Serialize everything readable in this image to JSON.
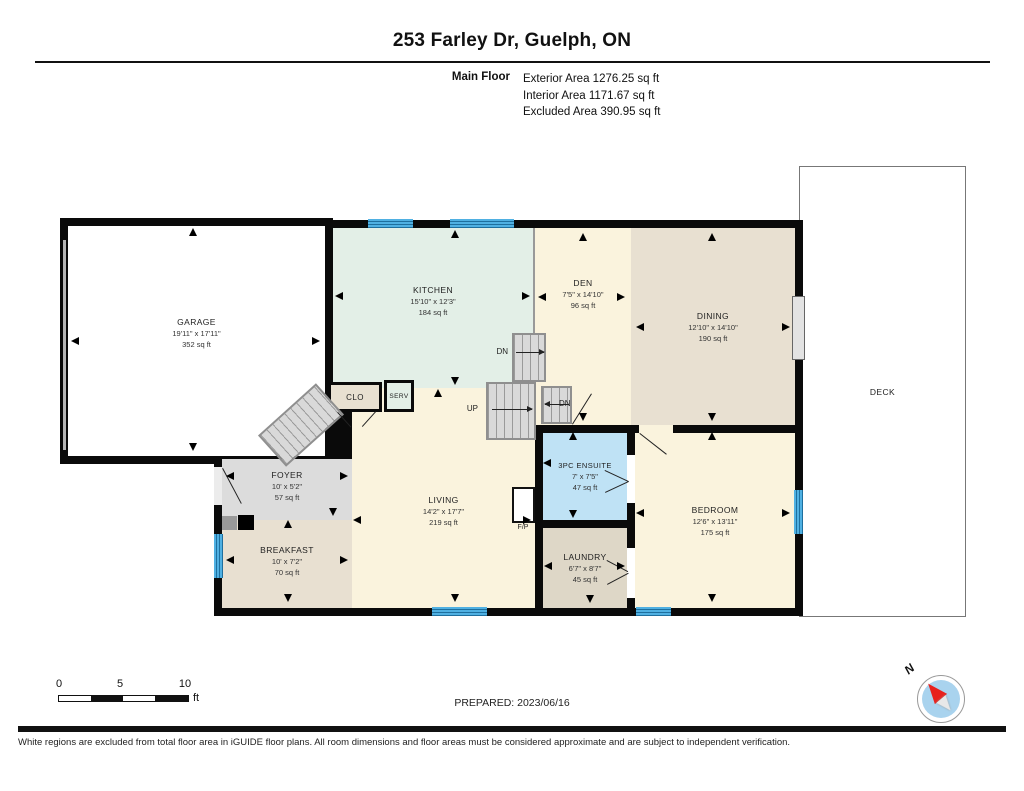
{
  "header": {
    "title": "253 Farley Dr, Guelph, ON",
    "floor_label": "Main Floor",
    "stats": [
      "Exterior Area 1276.25 sq ft",
      "Interior Area 1171.67 sq ft",
      "Excluded Area 390.95 sq ft"
    ]
  },
  "rooms": {
    "garage": {
      "name": "GARAGE",
      "dims": "19'11\" x 17'11\"",
      "area": "352 sq ft"
    },
    "kitchen": {
      "name": "KITCHEN",
      "dims": "15'10\" x 12'3\"",
      "area": "184 sq ft"
    },
    "den": {
      "name": "DEN",
      "dims": "7'5\" x 14'10\"",
      "area": "96 sq ft"
    },
    "dining": {
      "name": "DINING",
      "dims": "12'10\" x 14'10\"",
      "area": "190 sq ft"
    },
    "deck": {
      "name": "DECK"
    },
    "clo": {
      "name": "CLO"
    },
    "serv": {
      "name": "SERV"
    },
    "foyer": {
      "name": "FOYER",
      "dims": "10' x 5'2\"",
      "area": "57 sq ft"
    },
    "living": {
      "name": "LIVING",
      "dims": "14'2\" x 17'7\"",
      "area": "219 sq ft"
    },
    "breakfast": {
      "name": "BREAKFAST",
      "dims": "10' x 7'2\"",
      "area": "70 sq ft"
    },
    "ensuite": {
      "name": "3PC ENSUITE",
      "dims": "7' x 7'5\"",
      "area": "47 sq ft"
    },
    "laundry": {
      "name": "LAUNDRY",
      "dims": "6'7\" x 8'7\"",
      "area": "45 sq ft"
    },
    "bedroom": {
      "name": "BEDROOM",
      "dims": "12'6\" x 13'11\"",
      "area": "175 sq ft"
    }
  },
  "stairs": {
    "up": "UP",
    "dn_top": "DN",
    "dn_side": "DN"
  },
  "fireplace_label": "F/P",
  "scale_bar": {
    "ticks": [
      "0",
      "5",
      "10"
    ],
    "unit": "ft"
  },
  "prepared": "PREPARED: 2023/06/16",
  "compass": {
    "north_label": "N"
  },
  "footer": "White regions are excluded from total floor area in iGUIDE floor plans. All room dimensions and floor areas must be considered approximate and are subject to independent verification.",
  "colors": {
    "wall": "#0a0a0a",
    "cream": "#faf3dd",
    "mint": "#e3efe7",
    "tan": "#e8e0d1",
    "laundry_tan": "#ded7c7",
    "foyer_gray": "#dcdcdc",
    "ensuite_blue": "#bfe2f5",
    "window_blue": "#4fb0e2",
    "window_dark": "#1e6f9e",
    "stair_gray": "#d9d9d9",
    "compass_blue": "#a9d3ee",
    "compass_red": "#e8211d"
  }
}
